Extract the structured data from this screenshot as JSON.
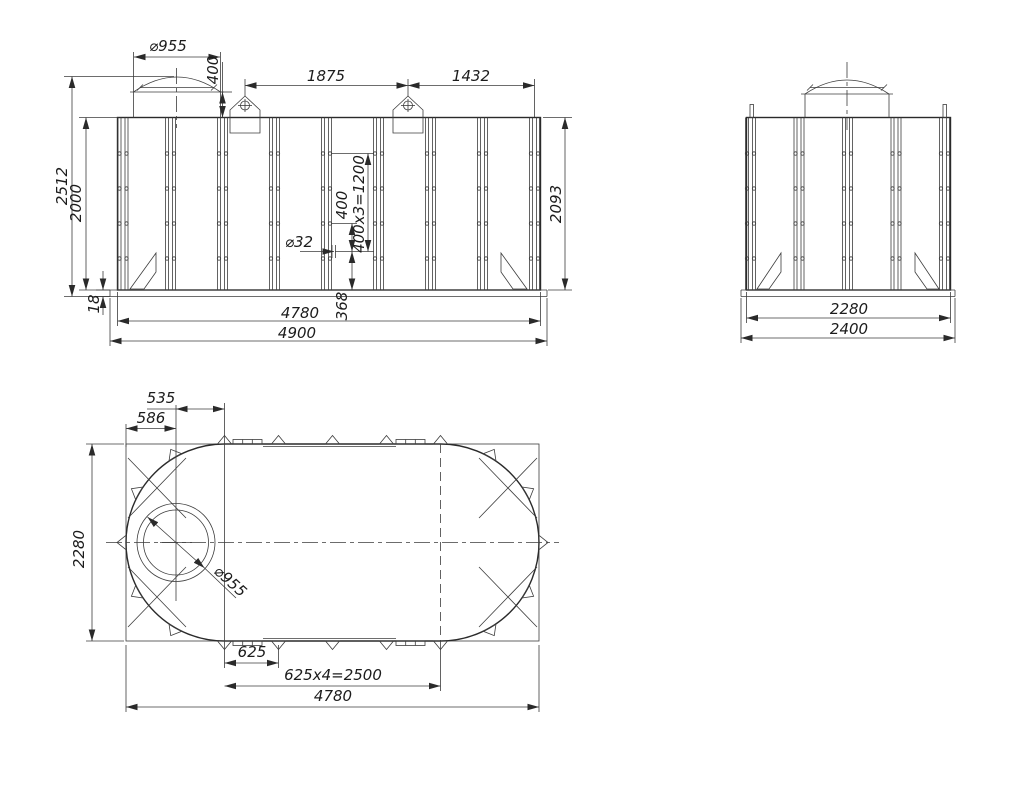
{
  "drawing": {
    "views": {
      "front": {
        "dims": {
          "manhole_dia": "⌀955",
          "manhole_height": "400",
          "lug_spacing": "1875",
          "lug_to_edge": "1432",
          "overall_height": "2512",
          "shell_height": "2000",
          "base_thickness": "18",
          "hole_step": "400",
          "hole_span": "400x3=1200",
          "nozzle_dia": "⌀32",
          "bottom_offset": "368",
          "right_height": "2093",
          "shell_length": "4780",
          "base_length": "4900"
        }
      },
      "side": {
        "dims": {
          "shell_width": "2280",
          "base_width": "2400"
        }
      },
      "plan": {
        "dims": {
          "manhole_to_seam": "535",
          "edge_to_manhole": "586",
          "width": "2280",
          "manhole_dia": "⌀955",
          "anchor_step": "625",
          "anchor_span": "625x4=2500",
          "length": "4780"
        }
      }
    }
  }
}
